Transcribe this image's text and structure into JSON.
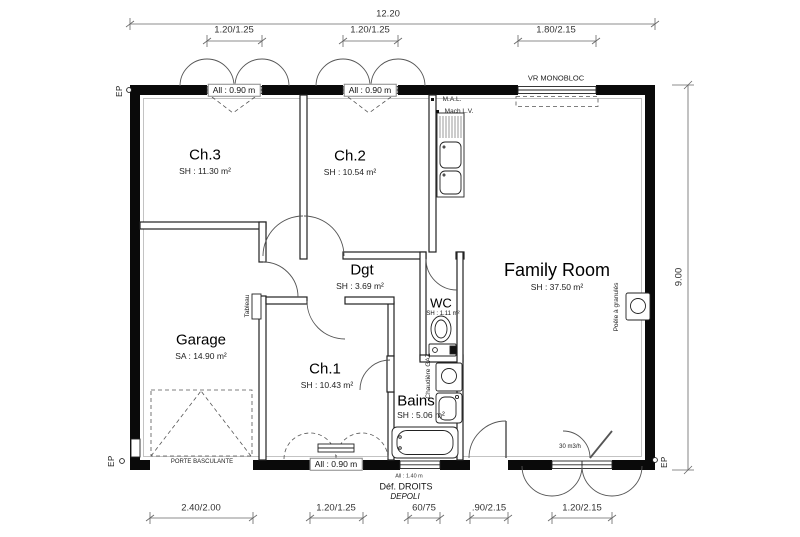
{
  "dimensions": {
    "top_total": "12.20",
    "top_segments": [
      "1.20/1.25",
      "1.20/1.25",
      "1.80/2.15"
    ],
    "right_total": "9.00",
    "bottom_segments": [
      "2.40/2.00",
      "1.20/1.25",
      "60/75",
      ".90/2.15",
      "1.20/2.15"
    ]
  },
  "rooms": [
    {
      "name": "Ch.3",
      "area": "SH : 11.30 m²"
    },
    {
      "name": "Ch.2",
      "area": "SH : 10.54 m²"
    },
    {
      "name": "Family Room",
      "area": "SH : 37.50 m²"
    },
    {
      "name": "Dgt",
      "area": "SH : 3.69 m²"
    },
    {
      "name": "WC",
      "area": "SH : 1.11 m²"
    },
    {
      "name": "Ch.1",
      "area": "SH : 10.43 m²"
    },
    {
      "name": "Bains",
      "area": "SH : 5.06 m²"
    },
    {
      "name": "Garage",
      "area": "SA : 14.90 m²"
    }
  ],
  "openings": {
    "window_sill_090": "All : 0.90 m",
    "window_sill_140": "All : 1.40 m",
    "roller_shutter": "VR MONOBLOC",
    "glazing_note_line1": "Déf. DROITS",
    "glazing_note_line2": "DEPOLI",
    "garage_door": "PORTE BASCULANTE",
    "air_vent": "30 m3/h"
  },
  "equipment": {
    "washing_machine": "M.A.L.",
    "dishwasher": "Mach L.V.",
    "electrical_panel": "Tableau",
    "boiler": "Chaudière GAZ",
    "pellet_stove": "Poêle à granulés"
  },
  "markers": {
    "downspout": "EP"
  }
}
